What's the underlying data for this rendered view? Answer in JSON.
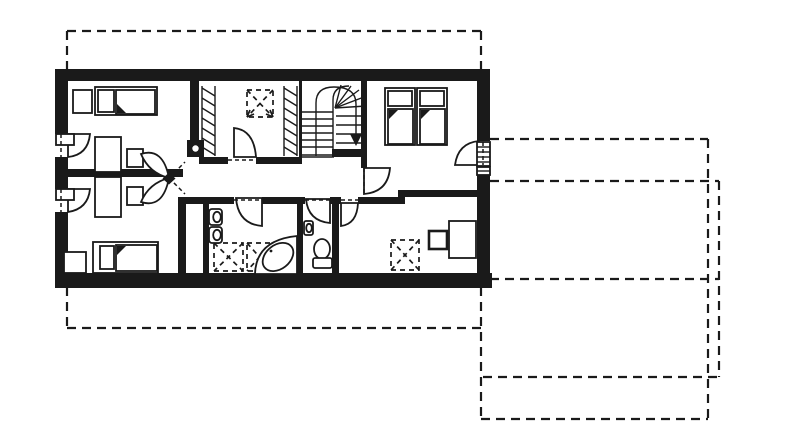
{
  "colors": {
    "ink": "#1a1a1a",
    "paper": "#ffffff"
  },
  "drawing": {
    "kind": "hand-drawn architectural floor plan, upper storey",
    "text_labels": []
  }
}
